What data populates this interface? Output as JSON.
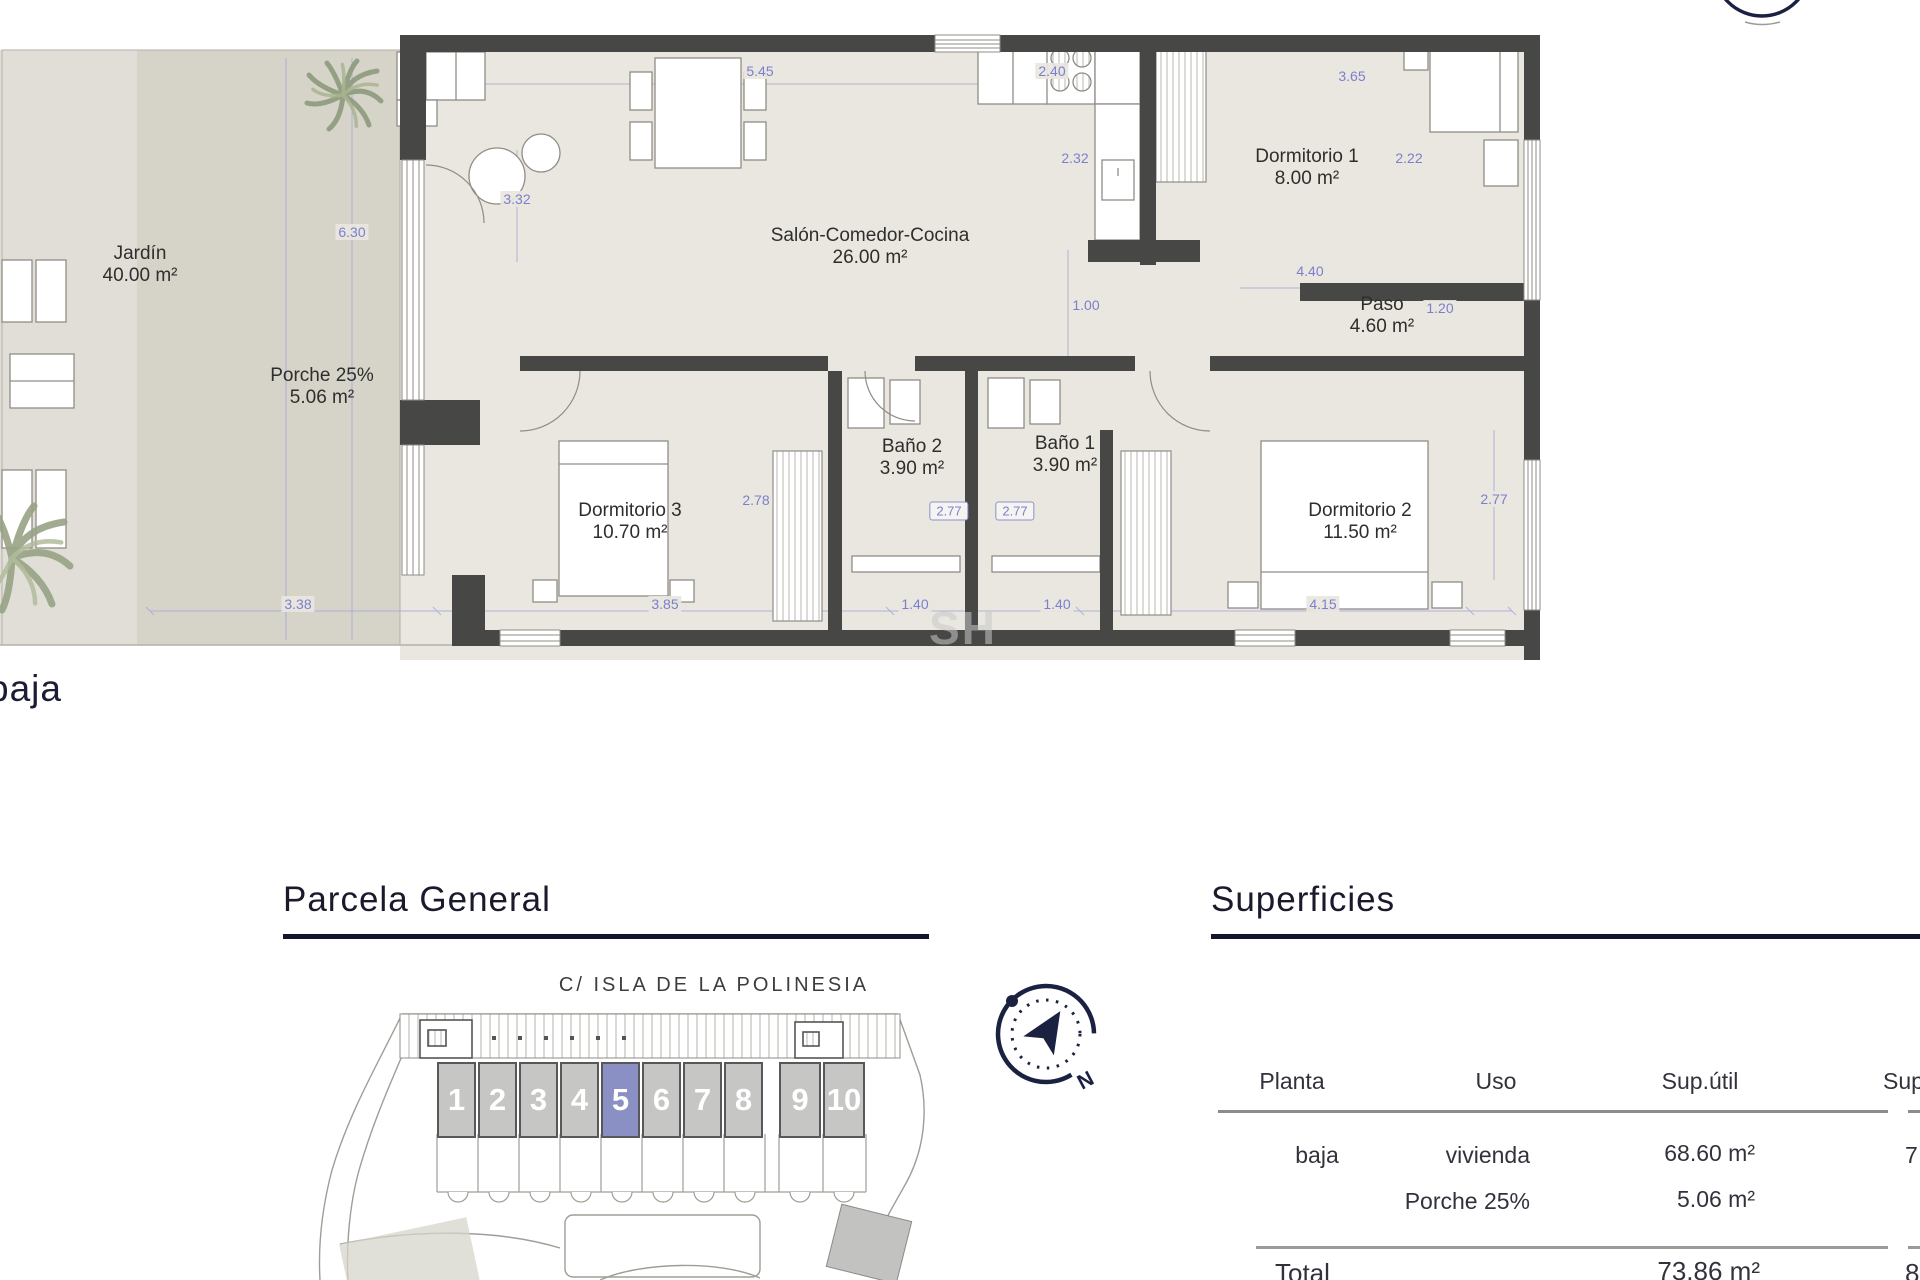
{
  "floorplan": {
    "floor_label": "baja",
    "watermark": "SH",
    "rooms": [
      {
        "id": "jardin",
        "name": "Jardín",
        "area": "40.00 m²",
        "x": 140,
        "y": 265
      },
      {
        "id": "porche",
        "name": "Porche 25%",
        "area": "5.06 m²",
        "x": 322,
        "y": 387
      },
      {
        "id": "salon",
        "name": "Salón-Comedor-Cocina",
        "area": "26.00 m²",
        "x": 870,
        "y": 247
      },
      {
        "id": "dormitorio-1",
        "name": "Dormitorio 1",
        "area": "8.00 m²",
        "x": 1307,
        "y": 168
      },
      {
        "id": "paso",
        "name": "Paso",
        "area": "4.60 m²",
        "x": 1382,
        "y": 316
      },
      {
        "id": "bano-2",
        "name": "Baño 2",
        "area": "3.90 m²",
        "x": 912,
        "y": 458
      },
      {
        "id": "bano-1",
        "name": "Baño 1",
        "area": "3.90 m²",
        "x": 1065,
        "y": 455
      },
      {
        "id": "dormitorio-3",
        "name": "Dormitorio 3",
        "area": "10.70 m²",
        "x": 630,
        "y": 522
      },
      {
        "id": "dormitorio-2",
        "name": "Dormitorio 2",
        "area": "11.50 m²",
        "x": 1360,
        "y": 522
      }
    ],
    "dimensions": [
      {
        "t": "6.30",
        "x": 352,
        "y": 232
      },
      {
        "t": "3.32",
        "x": 517,
        "y": 199
      },
      {
        "t": "5.45",
        "x": 760,
        "y": 71
      },
      {
        "t": "2.40",
        "x": 1052,
        "y": 71
      },
      {
        "t": "2.32",
        "x": 1075,
        "y": 158
      },
      {
        "t": "1.00",
        "x": 1086,
        "y": 305
      },
      {
        "t": "3.65",
        "x": 1352,
        "y": 76
      },
      {
        "t": "2.22",
        "x": 1409,
        "y": 158
      },
      {
        "t": "4.40",
        "x": 1310,
        "y": 271
      },
      {
        "t": "1.20",
        "x": 1440,
        "y": 308
      },
      {
        "t": "2.78",
        "x": 756,
        "y": 500
      },
      {
        "t": "2.77",
        "x": 1494,
        "y": 499
      },
      {
        "t": "3.38",
        "x": 298,
        "y": 604
      },
      {
        "t": "3.85",
        "x": 665,
        "y": 604
      },
      {
        "t": "1.40",
        "x": 915,
        "y": 604
      },
      {
        "t": "1.40",
        "x": 1057,
        "y": 604
      },
      {
        "t": "4.15",
        "x": 1323,
        "y": 604
      }
    ],
    "boxed_dimensions": [
      {
        "t": "2.77",
        "x": 949,
        "y": 511
      },
      {
        "t": "2.77",
        "x": 1015,
        "y": 511
      }
    ]
  },
  "parcela": {
    "title": "Parcela General",
    "street": "C/ ISLA DE LA POLINESIA",
    "units": [
      "1",
      "2",
      "3",
      "4",
      "5",
      "6",
      "7",
      "8",
      "9",
      "10"
    ],
    "highlighted_unit": "5",
    "compass": {
      "north_label": "N"
    }
  },
  "superficies": {
    "title": "Superficies",
    "table": {
      "headers": [
        "Planta",
        "Uso",
        "Sup.útil",
        "Sup"
      ],
      "row": {
        "planta": "baja",
        "uso": [
          "vivienda",
          "Porche 25%"
        ],
        "sup_util": [
          "68.60 m²",
          "5.06 m²"
        ],
        "sup_const_partial": "7"
      },
      "total": {
        "label": "Total",
        "sup_util": "73.86 m²",
        "sup_const_partial": "8"
      }
    }
  },
  "colors": {
    "accent_navy": "#14142c",
    "dimension_blue": "#7b80cc",
    "unit_highlight": "#8a8fc4",
    "wall_gray": "#474746"
  }
}
